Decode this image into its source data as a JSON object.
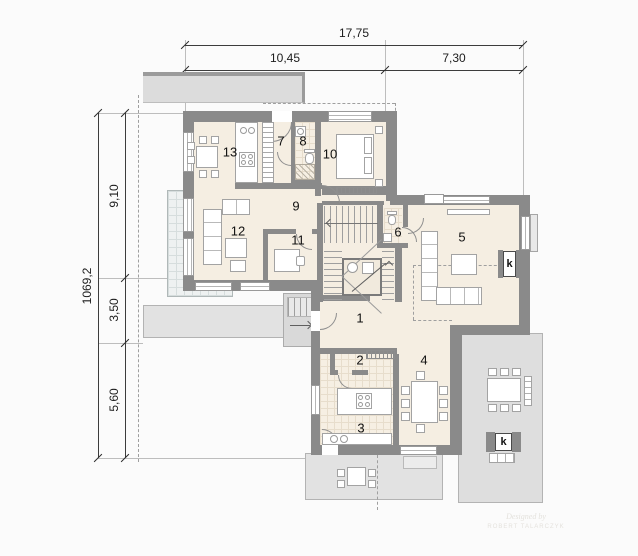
{
  "plan": {
    "dimensions": {
      "top_total": "17,75",
      "top_seg1": "10,45",
      "top_seg2": "7,30",
      "left_total": "1069,2",
      "left_seg1": "9,10",
      "left_seg2": "3,50",
      "left_seg3": "5,60"
    },
    "rooms": [
      {
        "number": "1"
      },
      {
        "number": "2"
      },
      {
        "number": "3"
      },
      {
        "number": "4"
      },
      {
        "number": "5"
      },
      {
        "number": "6"
      },
      {
        "number": "7"
      },
      {
        "number": "8"
      },
      {
        "number": "9"
      },
      {
        "number": "10"
      },
      {
        "number": "11"
      },
      {
        "number": "12"
      },
      {
        "number": "13"
      }
    ],
    "markers": {
      "fireplace": "k",
      "grill": "k"
    },
    "watermark": {
      "line1": "Designed by",
      "line2": "ROBERT TALARCZYK"
    },
    "colors": {
      "wall": "#8a8a8a",
      "floor": "#f5eee2",
      "terrace": "#e2e2e2",
      "dim_text": "#1c1c1c"
    }
  }
}
